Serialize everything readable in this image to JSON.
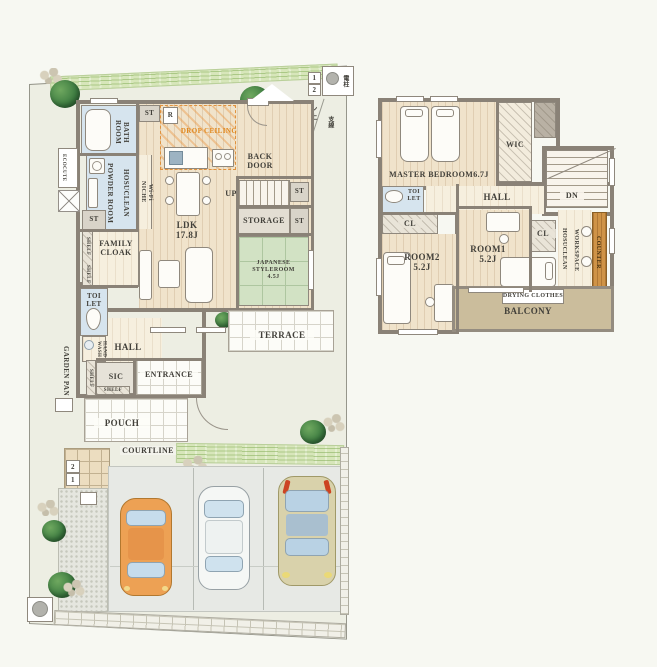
{
  "site": {
    "courtline": "COURTLINE",
    "garden_pan": "GARDEN PAN",
    "ecocute": "ECOCUTE",
    "doma_note": "土間コン\n刷毛仕上",
    "pole_label": "電柱",
    "guy_wire_label": "支線",
    "step1": "1",
    "step2": "2"
  },
  "floor1": {
    "bath": "BATH\nROOM",
    "st": "ST",
    "fridge": "R",
    "drop_ceiling": "DROP CEILING",
    "back_door": "BACK\nDOOR",
    "wifi_niche": "Wi-Fi\nNICHE",
    "hosuclean": "HOSUCLEAN",
    "powder_room": "POWDER ROOM",
    "shelf": "SHELF",
    "family_cloak": "FAMILY\nCLOAK",
    "ldk": "LDK\n17.8J",
    "up": "UP",
    "storage": "STORAGE",
    "japanese_room": "JAPANESE STYLEROOM\n4.5J",
    "terrace": "TERRACE",
    "toilet": "TOI\nLET",
    "hand_wash": "HAND\nWASH",
    "hall": "HALL",
    "sic": "SIC",
    "entrance": "ENTRANCE",
    "pouch": "POUCH"
  },
  "floor2": {
    "master_bedroom": "MASTER BEDROOM6.7J",
    "wic": "WIC",
    "hall": "HALL",
    "dn": "DN",
    "toilet": "TOI\nLET",
    "cl": "CL",
    "room2": "ROOM2\n5.2J",
    "room1": "ROOM1\n5.2J",
    "workspace": "WORKSPACE",
    "hosuclean": "HOSUCLEAN",
    "counter": "COUNTER",
    "drying_clothes": "DRYING CLOTHES",
    "balcony": "BALCONY"
  },
  "colors": {
    "wall": "#8a8277",
    "wood_floor": "#f0e3cb",
    "tatami": "#d2e2c4",
    "water_room": "#d6e4ee",
    "drop_ceiling_accent": "#e0881e",
    "balcony_tan": "#cbbd9c",
    "counter_wood": "#cf9347",
    "lawn": "#d7e6ba",
    "car_orange": "#eda154",
    "car_white": "#f5f7f5",
    "car_beige": "#d9d2ab"
  }
}
